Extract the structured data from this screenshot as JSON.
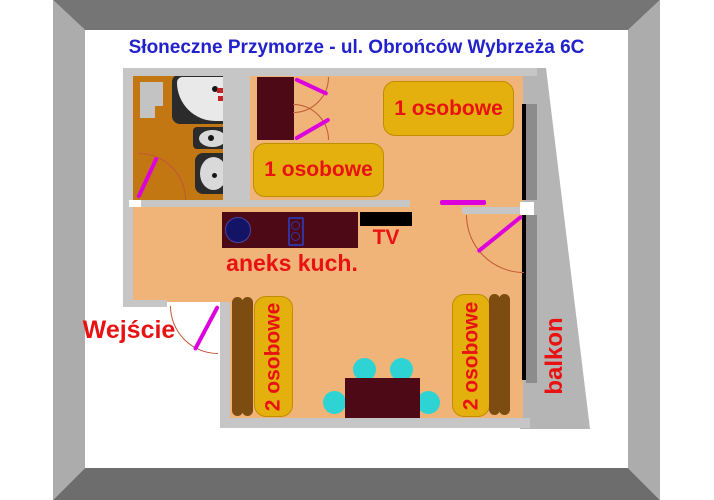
{
  "title": "Słoneczne Przymorze - ul. Obrońców Wybrzeża 6C",
  "rooms": {
    "kitchenette_label": "aneks kuch.",
    "entrance_label": "Wejście",
    "balcony_label": "balkon",
    "tv_label": "TV"
  },
  "furniture": {
    "single_bed_label": "1 osobowe",
    "double_bed_label": "2 osobowe"
  },
  "colors": {
    "title-blue": "#2222cc",
    "label-red": "#e81212",
    "floor": "#f0b478",
    "bathroom-floor": "#c27712",
    "wall": "#c6c6c6",
    "balcony-gray": "#b5b5b5",
    "window-sill": "#8c8c8c",
    "window-line": "#000000",
    "bed-yellow": "#e3b00e",
    "bed-yellow-border": "#c08c00",
    "bed-brown": "#7c4c10",
    "furniture-maroon": "#4e0916",
    "door-magenta": "#dd00dd",
    "chair-cyan": "#2ed3d3",
    "frame-top": "#757575",
    "frame-bottom": "#6d6d6d",
    "frame-side": "#acacac",
    "fixture-dark": "#2b2b2b",
    "fixture-light": "#d9d9d9",
    "sink-navy": "#141466",
    "hob-blue": "#3333a0",
    "arc-color": "#c05838"
  }
}
